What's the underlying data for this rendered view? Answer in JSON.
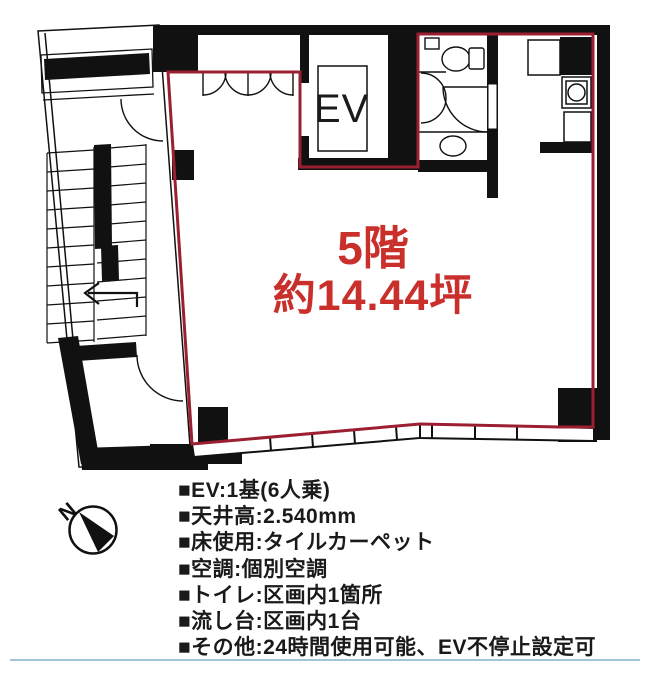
{
  "floor_plan": {
    "ev_label": "EV",
    "area_label": {
      "floor": "5階",
      "area": "約14.44坪"
    },
    "compass_letter": "N",
    "colors": {
      "boundary": "#9b1f31",
      "area_label_text": "#c9302c",
      "walls": "#111111",
      "divider_line": "#9fc6d8"
    }
  },
  "specs": {
    "items": [
      "■EV:1基(6人乗)",
      "■天井高:2.540mm",
      "■床使用:タイルカーペット",
      "■空調:個別空調",
      "■トイレ:区画内1箇所",
      "■流し台:区画内1台",
      "■その他:24時間使用可能、EV不停止設定可"
    ]
  }
}
